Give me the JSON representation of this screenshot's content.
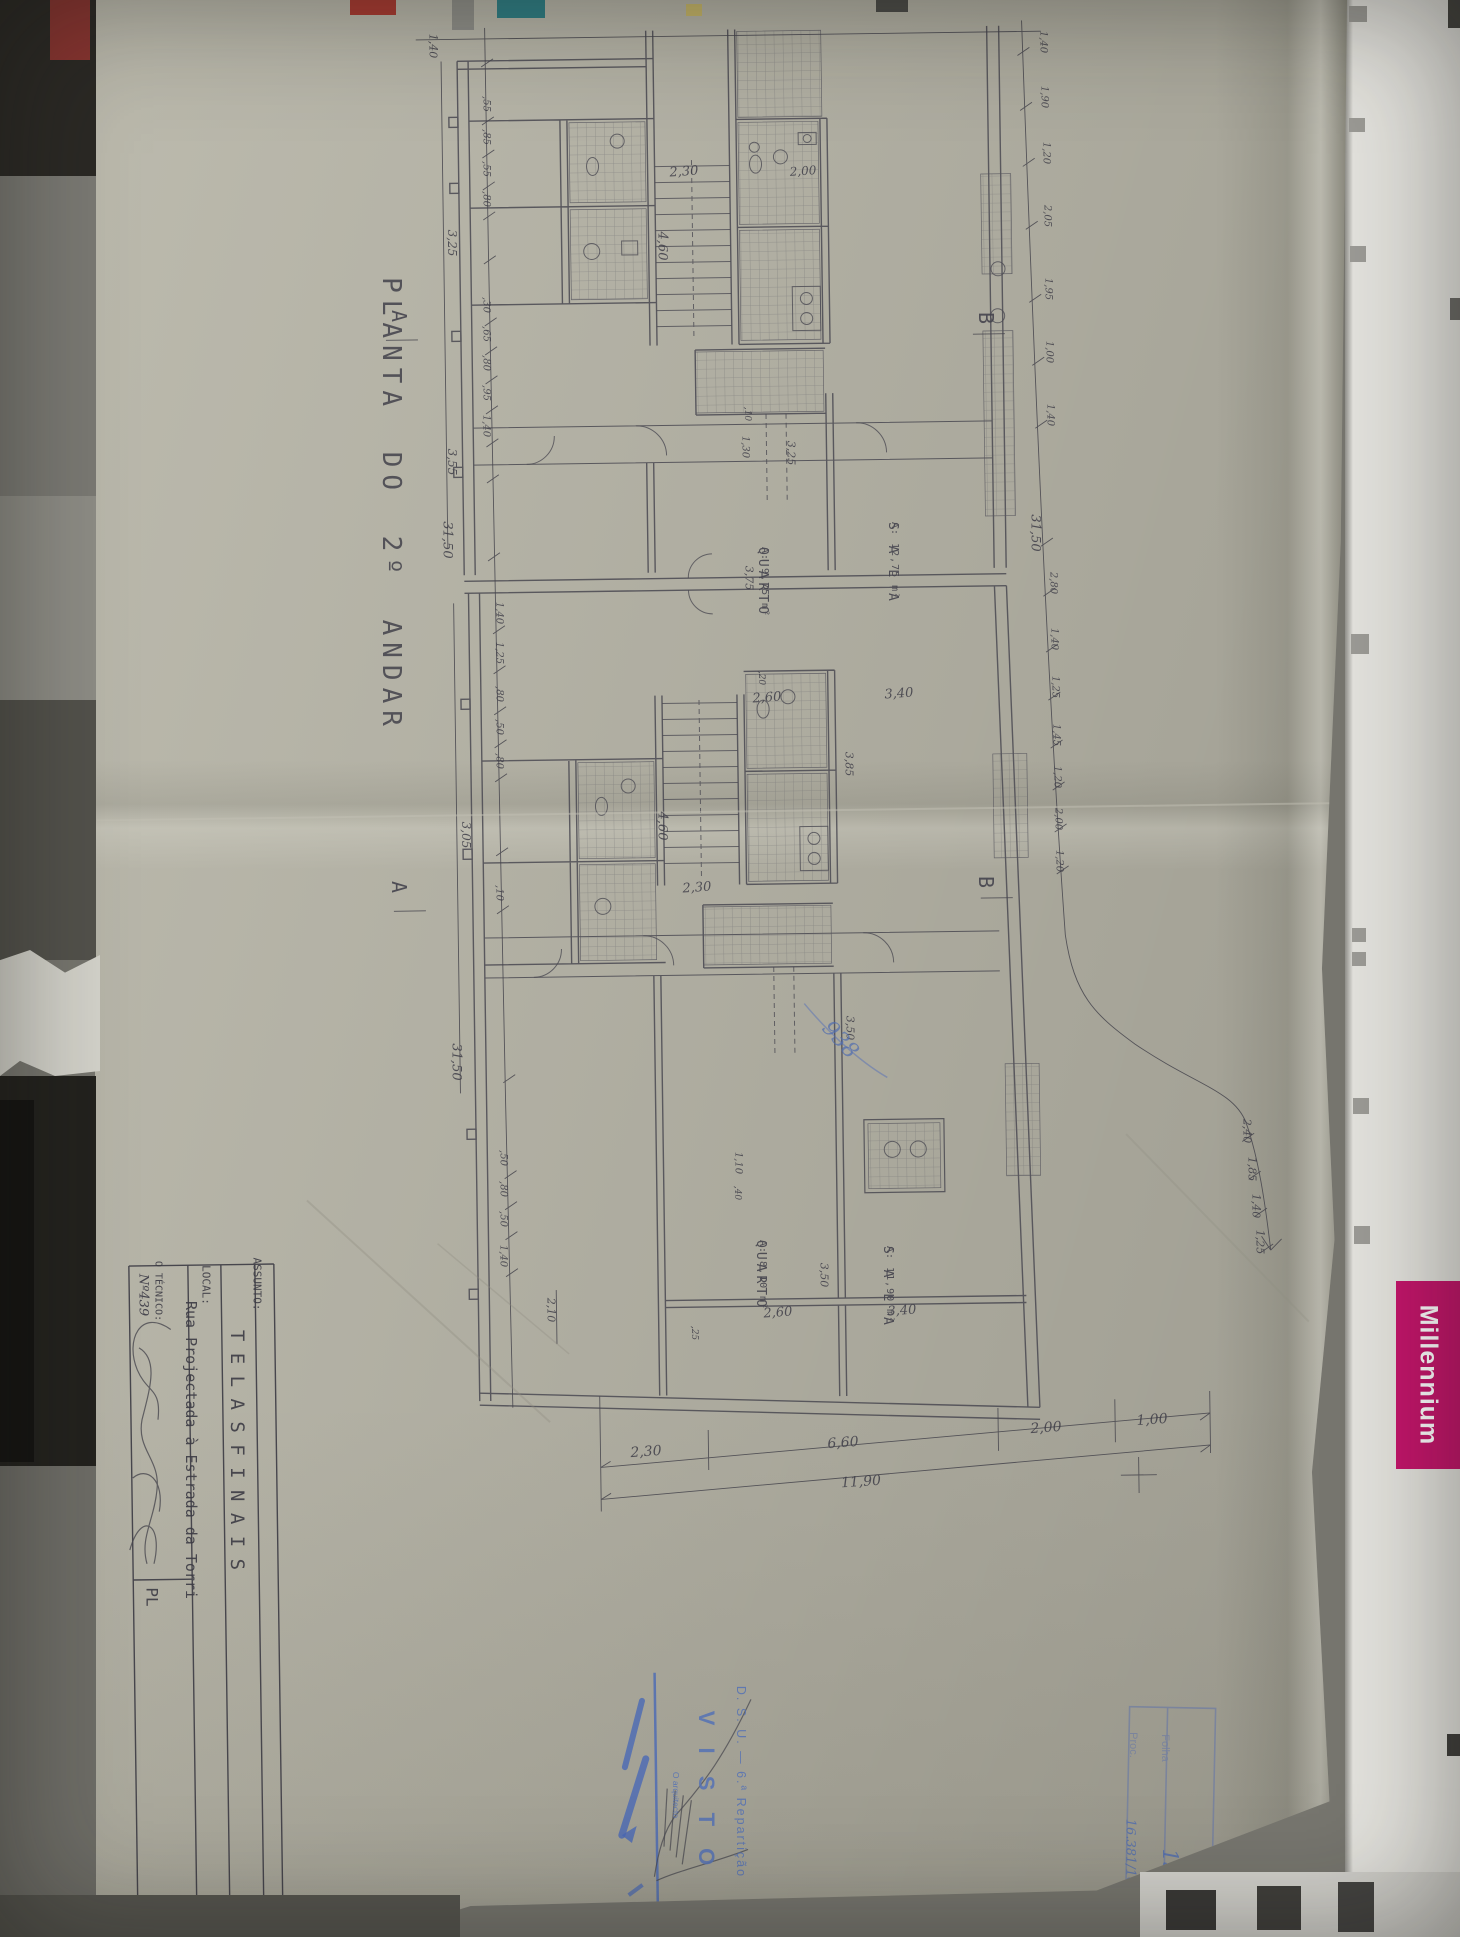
{
  "drawing": {
    "title": "PLANTA  DO  2º ANDAR",
    "rooms": [
      {
        "name": "QUARTO",
        "area": "A: 9,75 m²",
        "x": 770,
        "y": 547
      },
      {
        "name": "S A L A",
        "area": "A: 12,75 m²",
        "x": 900,
        "y": 522
      },
      {
        "name": "QUARTO",
        "area": "A: 8,10 m²",
        "x": 768,
        "y": 1240
      },
      {
        "name": "S A L A",
        "area": "A: 11,90 m²",
        "x": 895,
        "y": 1246
      }
    ],
    "sections": [
      {
        "label": "A",
        "x": 399,
        "y": 316
      },
      {
        "label": "A",
        "x": 399,
        "y": 887
      },
      {
        "label": "B",
        "x": 986,
        "y": 318
      },
      {
        "label": "B",
        "x": 986,
        "y": 882
      }
    ],
    "dimensions": [
      {
        "t": "1,40",
        "x": 433,
        "y": 46,
        "o": "v",
        "s": 11
      },
      {
        "t": ",55",
        "x": 486,
        "y": 104,
        "o": "v",
        "s": 10
      },
      {
        "t": ",85",
        "x": 486,
        "y": 137,
        "o": "v",
        "s": 10
      },
      {
        "t": ",55",
        "x": 486,
        "y": 169,
        "o": "v",
        "s": 10
      },
      {
        "t": ",80",
        "x": 486,
        "y": 199,
        "o": "v",
        "s": 10
      },
      {
        "t": "3,25",
        "x": 452,
        "y": 243,
        "o": "v",
        "s": 12
      },
      {
        "t": ",30",
        "x": 486,
        "y": 305,
        "o": "v",
        "s": 10
      },
      {
        "t": ",65",
        "x": 486,
        "y": 334,
        "o": "v",
        "s": 10
      },
      {
        "t": ",80",
        "x": 486,
        "y": 363,
        "o": "v",
        "s": 10
      },
      {
        "t": ",95",
        "x": 486,
        "y": 393,
        "o": "v",
        "s": 10
      },
      {
        "t": "1,40",
        "x": 486,
        "y": 426,
        "o": "v",
        "s": 10
      },
      {
        "t": "3,55",
        "x": 452,
        "y": 462,
        "o": "v",
        "s": 12
      },
      {
        "t": "31,50",
        "x": 447,
        "y": 540,
        "o": "v",
        "s": 13
      },
      {
        "t": "1,40",
        "x": 499,
        "y": 613,
        "o": "v",
        "s": 10
      },
      {
        "t": "1,25",
        "x": 499,
        "y": 653,
        "o": "v",
        "s": 10
      },
      {
        "t": ",80",
        "x": 499,
        "y": 694,
        "o": "v",
        "s": 10
      },
      {
        "t": ",50",
        "x": 499,
        "y": 727,
        "o": "v",
        "s": 10
      },
      {
        "t": ",80",
        "x": 499,
        "y": 761,
        "o": "v",
        "s": 10
      },
      {
        "t": "3,05",
        "x": 466,
        "y": 835,
        "o": "v",
        "s": 12
      },
      {
        "t": ",10",
        "x": 499,
        "y": 893,
        "o": "v",
        "s": 10
      },
      {
        "t": "31,50",
        "x": 456,
        "y": 1062,
        "o": "v",
        "s": 13
      },
      {
        "t": ",50",
        "x": 503,
        "y": 1158,
        "o": "v",
        "s": 10
      },
      {
        "t": ",80",
        "x": 503,
        "y": 1189,
        "o": "v",
        "s": 10
      },
      {
        "t": ",50",
        "x": 503,
        "y": 1219,
        "o": "v",
        "s": 10
      },
      {
        "t": "1,40",
        "x": 503,
        "y": 1256,
        "o": "v",
        "s": 10
      },
      {
        "t": "1,40",
        "x": 1043,
        "y": 42,
        "o": "v",
        "s": 10
      },
      {
        "t": "1,90",
        "x": 1044,
        "y": 97,
        "o": "v",
        "s": 10
      },
      {
        "t": "1,20",
        "x": 1046,
        "y": 153,
        "o": "v",
        "s": 10
      },
      {
        "t": "2,05",
        "x": 1047,
        "y": 216,
        "o": "v",
        "s": 10
      },
      {
        "t": "1,95",
        "x": 1048,
        "y": 289,
        "o": "v",
        "s": 10
      },
      {
        "t": "1,00",
        "x": 1049,
        "y": 352,
        "o": "v",
        "s": 10
      },
      {
        "t": "1,40",
        "x": 1050,
        "y": 415,
        "o": "v",
        "s": 10
      },
      {
        "t": "31,50",
        "x": 1035,
        "y": 533,
        "o": "v",
        "s": 13
      },
      {
        "t": "2,80",
        "x": 1053,
        "y": 583,
        "o": "v",
        "s": 10
      },
      {
        "t": "1,40",
        "x": 1054,
        "y": 639,
        "o": "v",
        "s": 10
      },
      {
        "t": "1,25",
        "x": 1055,
        "y": 687,
        "o": "v",
        "s": 10
      },
      {
        "t": "1,45",
        "x": 1056,
        "y": 735,
        "o": "v",
        "s": 10
      },
      {
        "t": "1,20",
        "x": 1057,
        "y": 777,
        "o": "v",
        "s": 10
      },
      {
        "t": "2,00",
        "x": 1058,
        "y": 819,
        "o": "v",
        "s": 10
      },
      {
        "t": "1,20",
        "x": 1059,
        "y": 861,
        "o": "v",
        "s": 10
      },
      {
        "t": "2,40",
        "x": 1247,
        "y": 1131,
        "o": "v",
        "s": 11
      },
      {
        "t": "1,85",
        "x": 1252,
        "y": 1169,
        "o": "v",
        "s": 11
      },
      {
        "t": "1,40",
        "x": 1256,
        "y": 1206,
        "o": "v",
        "s": 11
      },
      {
        "t": "1,25",
        "x": 1260,
        "y": 1242,
        "o": "v",
        "s": 11
      },
      {
        "t": ",10",
        "x": 747,
        "y": 414,
        "o": "v",
        "s": 9
      },
      {
        "t": "1,30",
        "x": 745,
        "y": 447,
        "o": "v",
        "s": 10
      },
      {
        "t": "3,25",
        "x": 791,
        "y": 453,
        "o": "v",
        "s": 11
      },
      {
        "t": "3,75",
        "x": 749,
        "y": 578,
        "o": "v",
        "s": 11
      },
      {
        "t": ",20",
        "x": 761,
        "y": 678,
        "o": "v",
        "s": 9
      },
      {
        "t": "4,60",
        "x": 662,
        "y": 246,
        "o": "v",
        "s": 13
      },
      {
        "t": "2,30",
        "x": 684,
        "y": 172,
        "o": "h",
        "s": 13
      },
      {
        "t": "2,00",
        "x": 803,
        "y": 171,
        "o": "h",
        "s": 12
      },
      {
        "t": "4,60",
        "x": 662,
        "y": 826,
        "o": "v",
        "s": 13
      },
      {
        "t": "2,30",
        "x": 697,
        "y": 888,
        "o": "h",
        "s": 13
      },
      {
        "t": "3,85",
        "x": 849,
        "y": 764,
        "o": "v",
        "s": 11
      },
      {
        "t": "3,50",
        "x": 850,
        "y": 1028,
        "o": "v",
        "s": 11
      },
      {
        "t": "2,60",
        "x": 767,
        "y": 698,
        "o": "h",
        "s": 13
      },
      {
        "t": "3,40",
        "x": 899,
        "y": 694,
        "o": "h",
        "s": 13
      },
      {
        "t": "1,10",
        "x": 738,
        "y": 1163,
        "o": "v",
        "s": 10
      },
      {
        "t": ",40",
        "x": 737,
        "y": 1193,
        "o": "v",
        "s": 9
      },
      {
        "t": "3,50",
        "x": 824,
        "y": 1275,
        "o": "v",
        "s": 11
      },
      {
        "t": "2,10",
        "x": 551,
        "y": 1310,
        "o": "v",
        "s": 11
      },
      {
        "t": ",25",
        "x": 694,
        "y": 1333,
        "o": "v",
        "s": 9
      },
      {
        "t": "2,60",
        "x": 778,
        "y": 1313,
        "o": "h",
        "s": 13
      },
      {
        "t": "3,40",
        "x": 902,
        "y": 1311,
        "o": "h",
        "s": 13
      },
      {
        "t": "2,30",
        "x": 646,
        "y": 1452,
        "o": "h",
        "s": 14
      },
      {
        "t": "6,60",
        "x": 843,
        "y": 1443,
        "o": "h",
        "s": 14
      },
      {
        "t": "2,00",
        "x": 1046,
        "y": 1428,
        "o": "h",
        "s": 14
      },
      {
        "t": "1,00",
        "x": 1152,
        "y": 1420,
        "o": "h",
        "s": 14
      },
      {
        "t": "11,90",
        "x": 861,
        "y": 1482,
        "o": "h",
        "s": 14
      }
    ],
    "blue_note": "938"
  },
  "title_block": {
    "assunto_label": "ASSUNTO:",
    "assunto_value": "T E L A S   F I N A I S",
    "local_label": "LOCAL:",
    "local_value": "Rua Projectada à Estrada da Torri",
    "tecnico_label": "O TÉCNICO:",
    "tecnico_number": "Nº439",
    "partial_cell": "PL"
  },
  "stamps": {
    "visto": {
      "line1": "D. S. U. — 6.ª Repartição",
      "line2": "V I S T O",
      "line3": "O arquitecto"
    },
    "folha": {
      "folha_label": "Folha",
      "folha_value": "13",
      "proc_label": "Proc.",
      "proc_value": "16.381/10"
    }
  },
  "side_strip": {
    "brand": "Millennium"
  },
  "colors": {
    "paper": "#b4b2a5",
    "pencil": "#4d4c54",
    "ink_blue": "#4f6cb0",
    "brand_magenta": "#c4156b"
  }
}
